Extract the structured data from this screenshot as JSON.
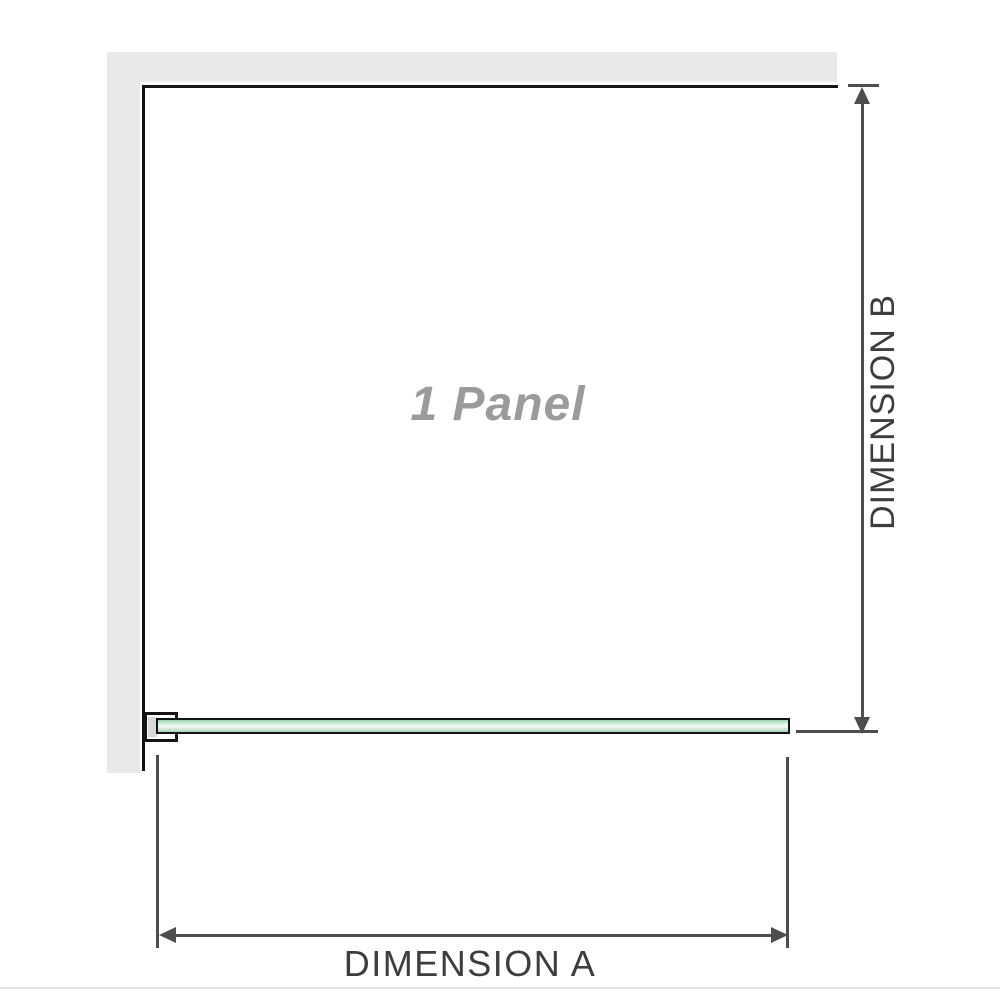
{
  "diagram": {
    "title": "Shower screen 1-panel dimension diagram",
    "panel_label": "1 Panel",
    "dimension_a_label": "DIMENSION A",
    "dimension_b_label": "DIMENSION B"
  },
  "colors": {
    "wall": "#e9e9e9",
    "outline": "#141414",
    "dimension_line": "#4d4d4d",
    "dimension_text": "#3d3d3d",
    "panel_label_text": "#9b9b9b",
    "bracket_fill": "#ffffff",
    "bracket_inner": "#d9d9d9",
    "glass_dark": "#96d1ae",
    "glass_mid": "#c9e8d5",
    "glass_light": "#f7fcf9",
    "baseline_rule": "#e5e1dd"
  }
}
